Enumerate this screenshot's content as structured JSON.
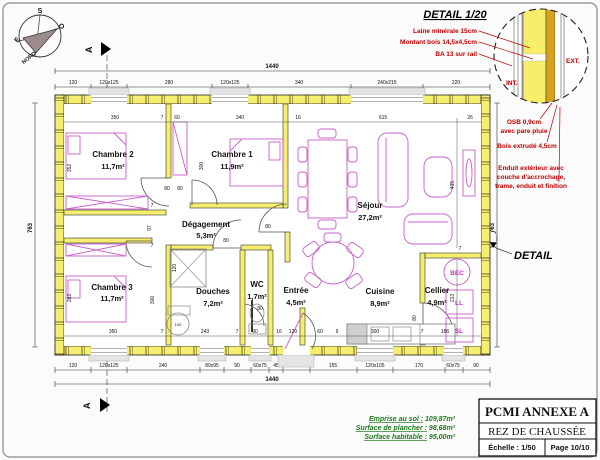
{
  "compass": {
    "n": "NORD",
    "s": "S",
    "e": "E",
    "o": "O"
  },
  "section": {
    "label": "A"
  },
  "detail": {
    "title": "DETAIL 1/20",
    "callout": "DETAIL",
    "int": "INT.",
    "ext": "EXT.",
    "laine": "Laine minérale 15cm",
    "montant": "Montant bois 14,5x4,5cm",
    "ba13": "BA 13 sur rail",
    "osb1": "OSB 0,9cm",
    "osb2": "avec pare pluie",
    "bois": "Bois extrudé 4,5cm",
    "enduit1": "Enduit extérieur avec",
    "enduit2": "couche d'accrochage,",
    "enduit3": "trame, enduit et finition"
  },
  "rooms": [
    {
      "name": "Chambre 2",
      "area": "11,7m²"
    },
    {
      "name": "Chambre 1",
      "area": "11,9m²"
    },
    {
      "name": "Dégagement",
      "area": "5,3m²"
    },
    {
      "name": "Séjour",
      "area": "27,2m²"
    },
    {
      "name": "Chambre 3",
      "area": "11,7m²"
    },
    {
      "name": "Douches",
      "area": "7,2m²"
    },
    {
      "name": "WC",
      "area": "1,7m²"
    },
    {
      "name": "Entrée",
      "area": "4,5m²"
    },
    {
      "name": "Cuisine",
      "area": "8,9m²"
    },
    {
      "name": "Cellier",
      "area": "4,9m²"
    }
  ],
  "appliances": {
    "bec": "BEC",
    "ll": "LL",
    "sl": "SL"
  },
  "dims": {
    "total_w_top": "1440",
    "total_w_bottom": "1440",
    "h_left": "763",
    "h_right": "763",
    "top": [
      "120",
      "120x125",
      "280",
      "120x125",
      "340",
      "240x215",
      "220"
    ],
    "bottom": [
      "120",
      "120x125",
      "240",
      "80x95",
      "90",
      "60x75",
      "45",
      "90x215",
      "155",
      "120x105",
      "170",
      "60x75",
      "90"
    ],
    "itop": [
      "350",
      "7",
      "60",
      "340",
      "16",
      "615",
      "26"
    ],
    "ibottom": [
      "350",
      "7",
      "243",
      "7",
      "90",
      "16",
      "120",
      "60",
      "9",
      "300",
      "7",
      "186"
    ],
    "v": {
      "ch2": "352",
      "ch3": "282",
      "a7": "7",
      "a97": "97",
      "b7": "7",
      "mid300a": "300",
      "mid300b": "300",
      "sejour": "435",
      "cellier": "213",
      "c7": "7"
    },
    "door": {
      "d80": "80",
      "d100": "100",
      "d120": "120"
    }
  },
  "titleblock": {
    "title": "PCMI ANNEXE A",
    "subtitle": "REZ DE CHAUSSÉE",
    "scale": "Échelle : 1/50",
    "page": "Page 10/10"
  },
  "surfaces": [
    {
      "label": "Emprise au sol :",
      "value": "109,87m²"
    },
    {
      "label": "Surface de plancher :",
      "value": "98,68m²"
    },
    {
      "label": "Surface habitable :",
      "value": "95,00m²"
    }
  ]
}
